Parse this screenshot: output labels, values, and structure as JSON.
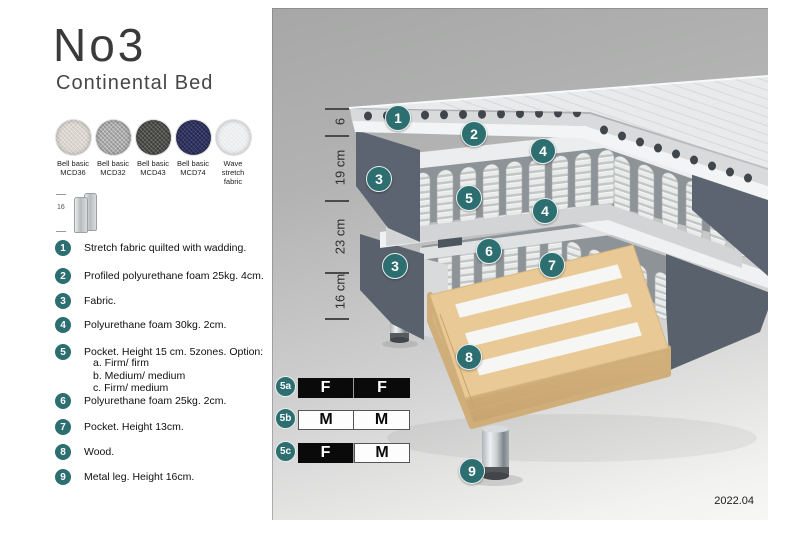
{
  "header": {
    "title": "No3",
    "subtitle": "Continental Bed"
  },
  "swatches": [
    {
      "line1": "Bell basic",
      "line2": "MCD36",
      "color": "#d8d4cd"
    },
    {
      "line1": "Bell basic",
      "line2": "MCD32",
      "color": "#a8a8a8"
    },
    {
      "line1": "Bell basic",
      "line2": "MCD43",
      "color": "#4d4d4b"
    },
    {
      "line1": "Bell basic",
      "line2": "MCD74",
      "color": "#30335a"
    },
    {
      "line1": "Wave",
      "line2": "stretch fabric",
      "color": "#eceef0"
    }
  ],
  "leg_icon": {
    "height_label": "16"
  },
  "materials": [
    {
      "num": "1",
      "text": "Stretch fabric quilted with wadding."
    },
    {
      "num": "2",
      "text": "Profiled polyurethane foam 25kg. 4cm."
    },
    {
      "num": "3",
      "text": "Fabric."
    },
    {
      "num": "4",
      "text": "Polyurethane foam 30kg. 2cm."
    },
    {
      "num": "5",
      "text": "Pocket. Height 15 cm. 5zones. Option:",
      "options": [
        "a. Firm/ firm",
        "b. Medium/ medium",
        "c. Firm/ medium"
      ]
    },
    {
      "num": "6",
      "text": "Polyurethane foam 25kg. 2cm."
    },
    {
      "num": "7",
      "text": "Pocket. Height 13cm."
    },
    {
      "num": "8",
      "text": "Wood."
    },
    {
      "num": "9",
      "text": "Metal leg. Height 16cm."
    }
  ],
  "diagram": {
    "dimensions": [
      {
        "label": "6"
      },
      {
        "label": "19 cm"
      },
      {
        "label": "23 cm"
      },
      {
        "label": "16 cm"
      }
    ],
    "callouts": [
      {
        "label": "1"
      },
      {
        "label": "2"
      },
      {
        "label": "4"
      },
      {
        "label": "3"
      },
      {
        "label": "5"
      },
      {
        "label": "4"
      },
      {
        "label": "6"
      },
      {
        "label": "7"
      },
      {
        "label": "3"
      },
      {
        "label": "8"
      },
      {
        "label": "9"
      }
    ],
    "firmness_tables": [
      {
        "id": "5a",
        "cells": [
          "F",
          "F"
        ]
      },
      {
        "id": "5b",
        "cells": [
          "M",
          "M"
        ]
      },
      {
        "id": "5c",
        "cells": [
          "F",
          "M"
        ]
      }
    ],
    "version_date": "2022.04"
  },
  "colors": {
    "accent_teal": "#2d6e71",
    "fabric_dark": "#5b6470",
    "mattress_light": "#e8eaec",
    "wood": "#e9c996",
    "chrome": "#c7ccce"
  }
}
